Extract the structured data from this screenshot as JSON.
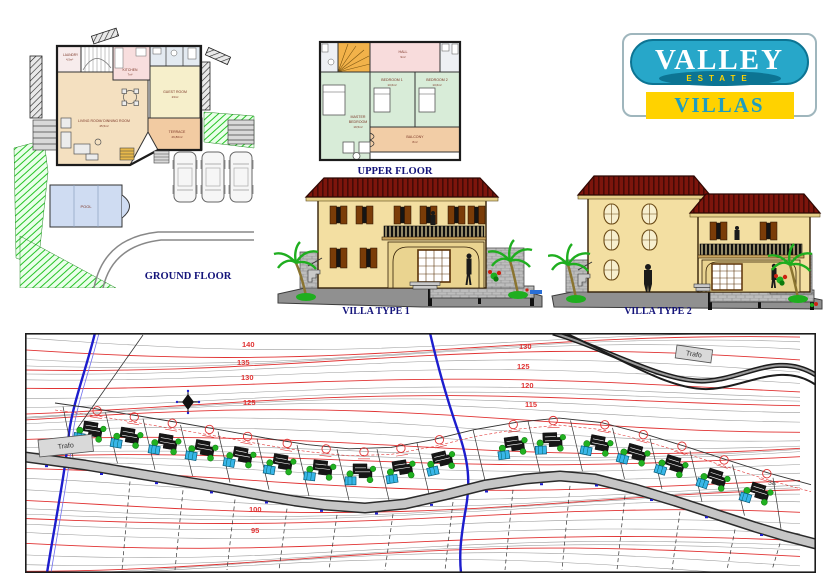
{
  "titles": {
    "ground_floor": "GROUND FLOOR",
    "upper_floor": "UPPER FLOOR",
    "villa1": "VILLA TYPE  1",
    "villa2": "VILLA TYPE  2"
  },
  "ground_floor": {
    "laundry_name": "LAUNDRY",
    "laundry_area": "4,5m²",
    "kitchen_name": "KITCHEN",
    "kitchen_area": "7m²",
    "living_name": "LIVING ROOM/ DINNING ROOM",
    "living_area": "45,5m²",
    "guest_name": "GUEST ROOM",
    "guest_area": "23m²",
    "terrace_name": "TERRACE",
    "terrace_area": "26,80m²",
    "pool_name": "POOL"
  },
  "upper_floor": {
    "hall_name": "HALL",
    "hall_area": "9m²",
    "bedroom1_name": "BEDROOM 1",
    "bedroom1_area": "13,6m²",
    "bedroom2_name": "BEDROOM 2",
    "bedroom2_area": "13,6m²",
    "master_name1": "MASTER",
    "master_name2": "BEDROOM",
    "master_area": "19,5m²",
    "balcony_name": "BALCONY",
    "balcony_area": "8m²"
  },
  "logo": {
    "valley": "VALLEY",
    "estate": "ESTATE",
    "villas": "VILLAS",
    "colors": {
      "teal": "#27a7c9",
      "band": "#0c7493",
      "yellow": "#ffd200",
      "villas_text": "#1f9dbf"
    }
  },
  "site_plan": {
    "trafo_left": "Trafo",
    "trafo_right": "Trafo",
    "corner_note": "3a",
    "villa_count": 17,
    "contour_labels": [
      {
        "x": 217,
        "y": 14,
        "text": "140"
      },
      {
        "x": 212,
        "y": 32,
        "text": "135"
      },
      {
        "x": 216,
        "y": 47,
        "text": "130"
      },
      {
        "x": 218,
        "y": 72,
        "text": "125"
      },
      {
        "x": 494,
        "y": 16,
        "text": "130"
      },
      {
        "x": 492,
        "y": 36,
        "text": "125"
      },
      {
        "x": 496,
        "y": 55,
        "text": "120"
      },
      {
        "x": 500,
        "y": 74,
        "text": "115"
      },
      {
        "x": 224,
        "y": 179,
        "text": "100"
      },
      {
        "x": 226,
        "y": 200,
        "text": "95"
      }
    ],
    "colors": {
      "contour_minor": "#9a9a9a",
      "contour_major": "#e03333",
      "stream": "#1d1dcd",
      "road_dark": "#2b2b2b",
      "road_fill": "#c6c6c6",
      "tree": "#21b121",
      "tree_dark": "#0c7a0c",
      "pool": "#38b6e8",
      "boundary": "#333333",
      "dashed_red": "#e03333"
    }
  }
}
